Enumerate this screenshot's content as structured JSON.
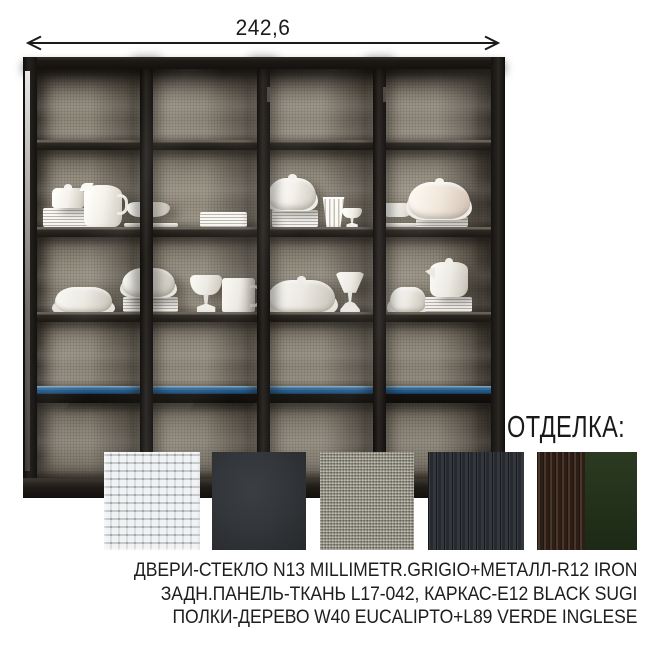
{
  "dimension": {
    "label": "242,6"
  },
  "cabinet": {
    "frame_color": "#1d1a16",
    "back_panel_color": "#8e8678",
    "glass_shelf_color": "#245d90",
    "wood_shelf_color": "#2e2a25",
    "contents_icon": "porcelain-dishware"
  },
  "finish": {
    "heading": "ОТДЕЛКА:",
    "swatches": [
      {
        "name": "glass-millimetr-grigio",
        "color": "#c9ced0"
      },
      {
        "name": "metal-iron",
        "color": "#33363a"
      },
      {
        "name": "fabric-l17-042",
        "color": "#8f8c80"
      },
      {
        "name": "wood-black-sugi",
        "color": "#31353b"
      },
      {
        "name": "wood-eucalipto",
        "color": "#39291f"
      },
      {
        "name": "verde-inglese",
        "color": "#22301a"
      }
    ]
  },
  "description": {
    "lines": [
      "ДВЕРИ-СТЕКЛО N13 MILLIMETR.GRIGIO+МЕТАЛЛ-R12 IRON",
      "ЗАДН.ПАНЕЛЬ-ТКАНЬ L17-042, КАРКАС-E12 BLACK SUGI",
      "ПОЛКИ-ДЕРЕВО W40 EUCALIPTO+L89 VERDE INGLESE"
    ]
  }
}
